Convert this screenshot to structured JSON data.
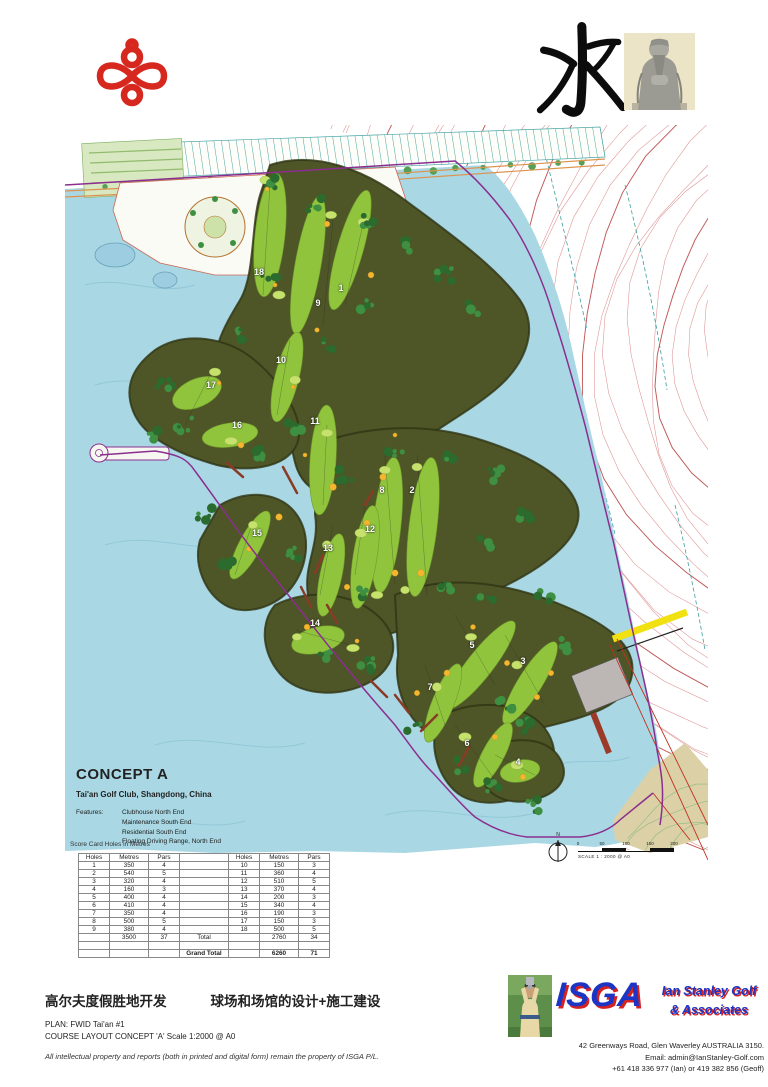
{
  "header": {
    "knot_logo": "chinese-knot",
    "water_character": "水",
    "statue": "confucius-statue-photo"
  },
  "concept": {
    "title": "CONCEPT A",
    "subtitle": "Tai'an Golf Club, Shangdong, China",
    "features_label": "Features:",
    "features": [
      "Clubhouse North End",
      "Maintenance South End",
      "Residential South End",
      "Floating Driving Range, North End"
    ]
  },
  "scorecard": {
    "note": "Score Card Holes in Metres",
    "headers": [
      "Holes",
      "Metres",
      "Pars",
      "",
      "Holes",
      "Metres",
      "Pars"
    ],
    "rows": [
      [
        "1",
        "350",
        "4",
        "",
        "10",
        "150",
        "3"
      ],
      [
        "2",
        "540",
        "5",
        "",
        "11",
        "360",
        "4"
      ],
      [
        "3",
        "320",
        "4",
        "",
        "12",
        "510",
        "5"
      ],
      [
        "4",
        "160",
        "3",
        "",
        "13",
        "370",
        "4"
      ],
      [
        "5",
        "400",
        "4",
        "",
        "14",
        "200",
        "3"
      ],
      [
        "6",
        "410",
        "4",
        "",
        "15",
        "340",
        "4"
      ],
      [
        "7",
        "350",
        "4",
        "",
        "16",
        "190",
        "3"
      ],
      [
        "8",
        "500",
        "5",
        "",
        "17",
        "150",
        "3"
      ],
      [
        "9",
        "380",
        "4",
        "",
        "18",
        "500",
        "5"
      ],
      [
        "",
        "3500",
        "37",
        "Total",
        "",
        "2760",
        "34"
      ],
      [
        "",
        "",
        "",
        "",
        "",
        "",
        ""
      ],
      [
        "",
        "",
        "",
        "Grand Total",
        "",
        "6260",
        "71"
      ]
    ]
  },
  "map": {
    "hole_markers": [
      {
        "n": "18",
        "x": 194,
        "y": 147
      },
      {
        "n": "1",
        "x": 276,
        "y": 163
      },
      {
        "n": "9",
        "x": 253,
        "y": 178
      },
      {
        "n": "10",
        "x": 216,
        "y": 235
      },
      {
        "n": "17",
        "x": 146,
        "y": 260
      },
      {
        "n": "16",
        "x": 172,
        "y": 300
      },
      {
        "n": "11",
        "x": 250,
        "y": 296
      },
      {
        "n": "8",
        "x": 317,
        "y": 365
      },
      {
        "n": "2",
        "x": 347,
        "y": 365
      },
      {
        "n": "12",
        "x": 305,
        "y": 404
      },
      {
        "n": "13",
        "x": 263,
        "y": 423
      },
      {
        "n": "15",
        "x": 192,
        "y": 408
      },
      {
        "n": "14",
        "x": 250,
        "y": 498
      },
      {
        "n": "5",
        "x": 407,
        "y": 520
      },
      {
        "n": "3",
        "x": 458,
        "y": 536
      },
      {
        "n": "7",
        "x": 365,
        "y": 562
      },
      {
        "n": "6",
        "x": 402,
        "y": 618
      },
      {
        "n": "4",
        "x": 453,
        "y": 637
      }
    ],
    "north_label": "N",
    "scale_ticks": [
      "0",
      "50",
      "100",
      "150",
      "200 m"
    ],
    "scale_text": "SCALE 1 : 2000 @ A0"
  },
  "footer": {
    "cn_left": "高尔夫度假胜地开发",
    "cn_right": "球场和场馆的设计+施工建设",
    "plan_line": "PLAN: FWID Tai'an #1",
    "layout_line": "COURSE LAYOUT CONCEPT 'A' Scale 1:2000 @ A0",
    "disclaimer": "All intellectual property and reports (both in printed and digital form) remain the property of ISGA P/L.",
    "isga": {
      "acronym": "ISGA",
      "name_line1": "Ian Stanley Golf",
      "name_line2": "& Associates",
      "address": "42 Greenways Road, Glen Waverley AUSTRALIA 3150.",
      "email": "Email: admin@IanStanley-Golf.com",
      "phone": "+61 418 336 977 (Ian) or 419 382 856 (Geoff)"
    }
  },
  "colors": {
    "water": "#a9d8e4",
    "fairway": "#8fc43c",
    "rough": "#4e5526",
    "contour": "#dd9090",
    "boundary_purple": "#8b2f8f",
    "knot_red": "#d6281e",
    "isga_blue": "#1d35c4",
    "isga_red": "#d42222",
    "bunker": "#f3b62e",
    "road_yellow": "#f2e112"
  }
}
